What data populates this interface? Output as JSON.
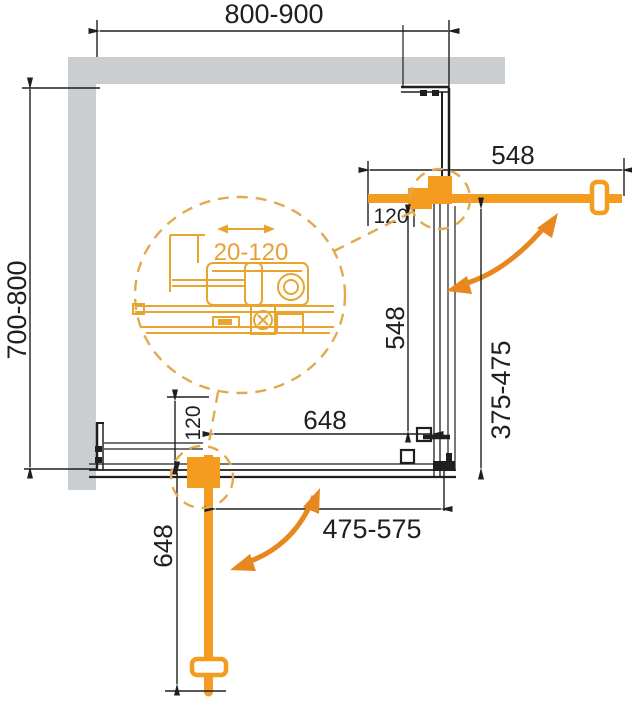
{
  "diagram": {
    "type": "shower-enclosure-installation-plan",
    "dims": {
      "top_width": "800-900",
      "left_depth": "700-800",
      "door_top_length": "548",
      "door_top_offset": "120",
      "panel_right_height": "548",
      "opening_right": "375-475",
      "panel_bottom_width": "648",
      "door_bottom_offset": "120",
      "door_bottom_length": "648",
      "opening_bottom": "475-575",
      "detail_adjustment": "20-120"
    },
    "colors": {
      "accent_orange": "#f39c1f",
      "detail_orange": "#e9a42e",
      "dashed_orange": "#e2a94e",
      "wall_gray": "#cbced0",
      "line_black": "#1f1f1f"
    }
  }
}
